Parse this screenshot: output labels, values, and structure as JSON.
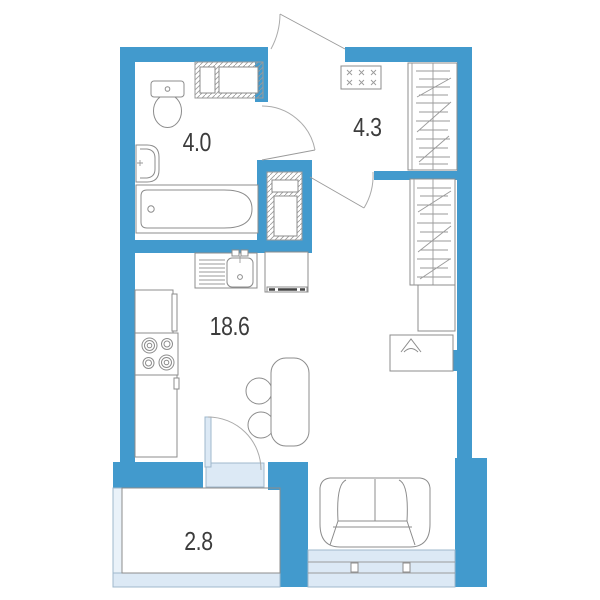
{
  "title": "Studio apartment floor plan",
  "colors": {
    "wall": "#429ACD",
    "glazing": "#DCE9F5",
    "glazing-border": "#9FB8CC",
    "outline": "#8C8C8C",
    "label": "#3C3C3C"
  },
  "rooms": {
    "bathroom": {
      "name": "bathroom",
      "area": "4.0"
    },
    "hallway": {
      "name": "hallway",
      "area": "4.3"
    },
    "living_kitchen": {
      "name": "kitchen-living room",
      "area": "18.6"
    },
    "balcony": {
      "name": "balcony",
      "area": "2.8"
    }
  },
  "fixtures": [
    "toilet",
    "washbasin",
    "bathtub",
    "ventilation-shaft",
    "ventilation-shaft-2",
    "electrical-panel",
    "hallway-wardrobe",
    "living-room-wardrobe",
    "cabinet",
    "tv-stand",
    "kitchen-sink",
    "refrigerator",
    "kitchen-cabinet",
    "stove",
    "kitchen-counter",
    "dining-table",
    "chair",
    "chair",
    "sofa",
    "entrance-door",
    "bathroom-door",
    "living-room-door",
    "balcony-door",
    "window",
    "balcony-glazing"
  ]
}
